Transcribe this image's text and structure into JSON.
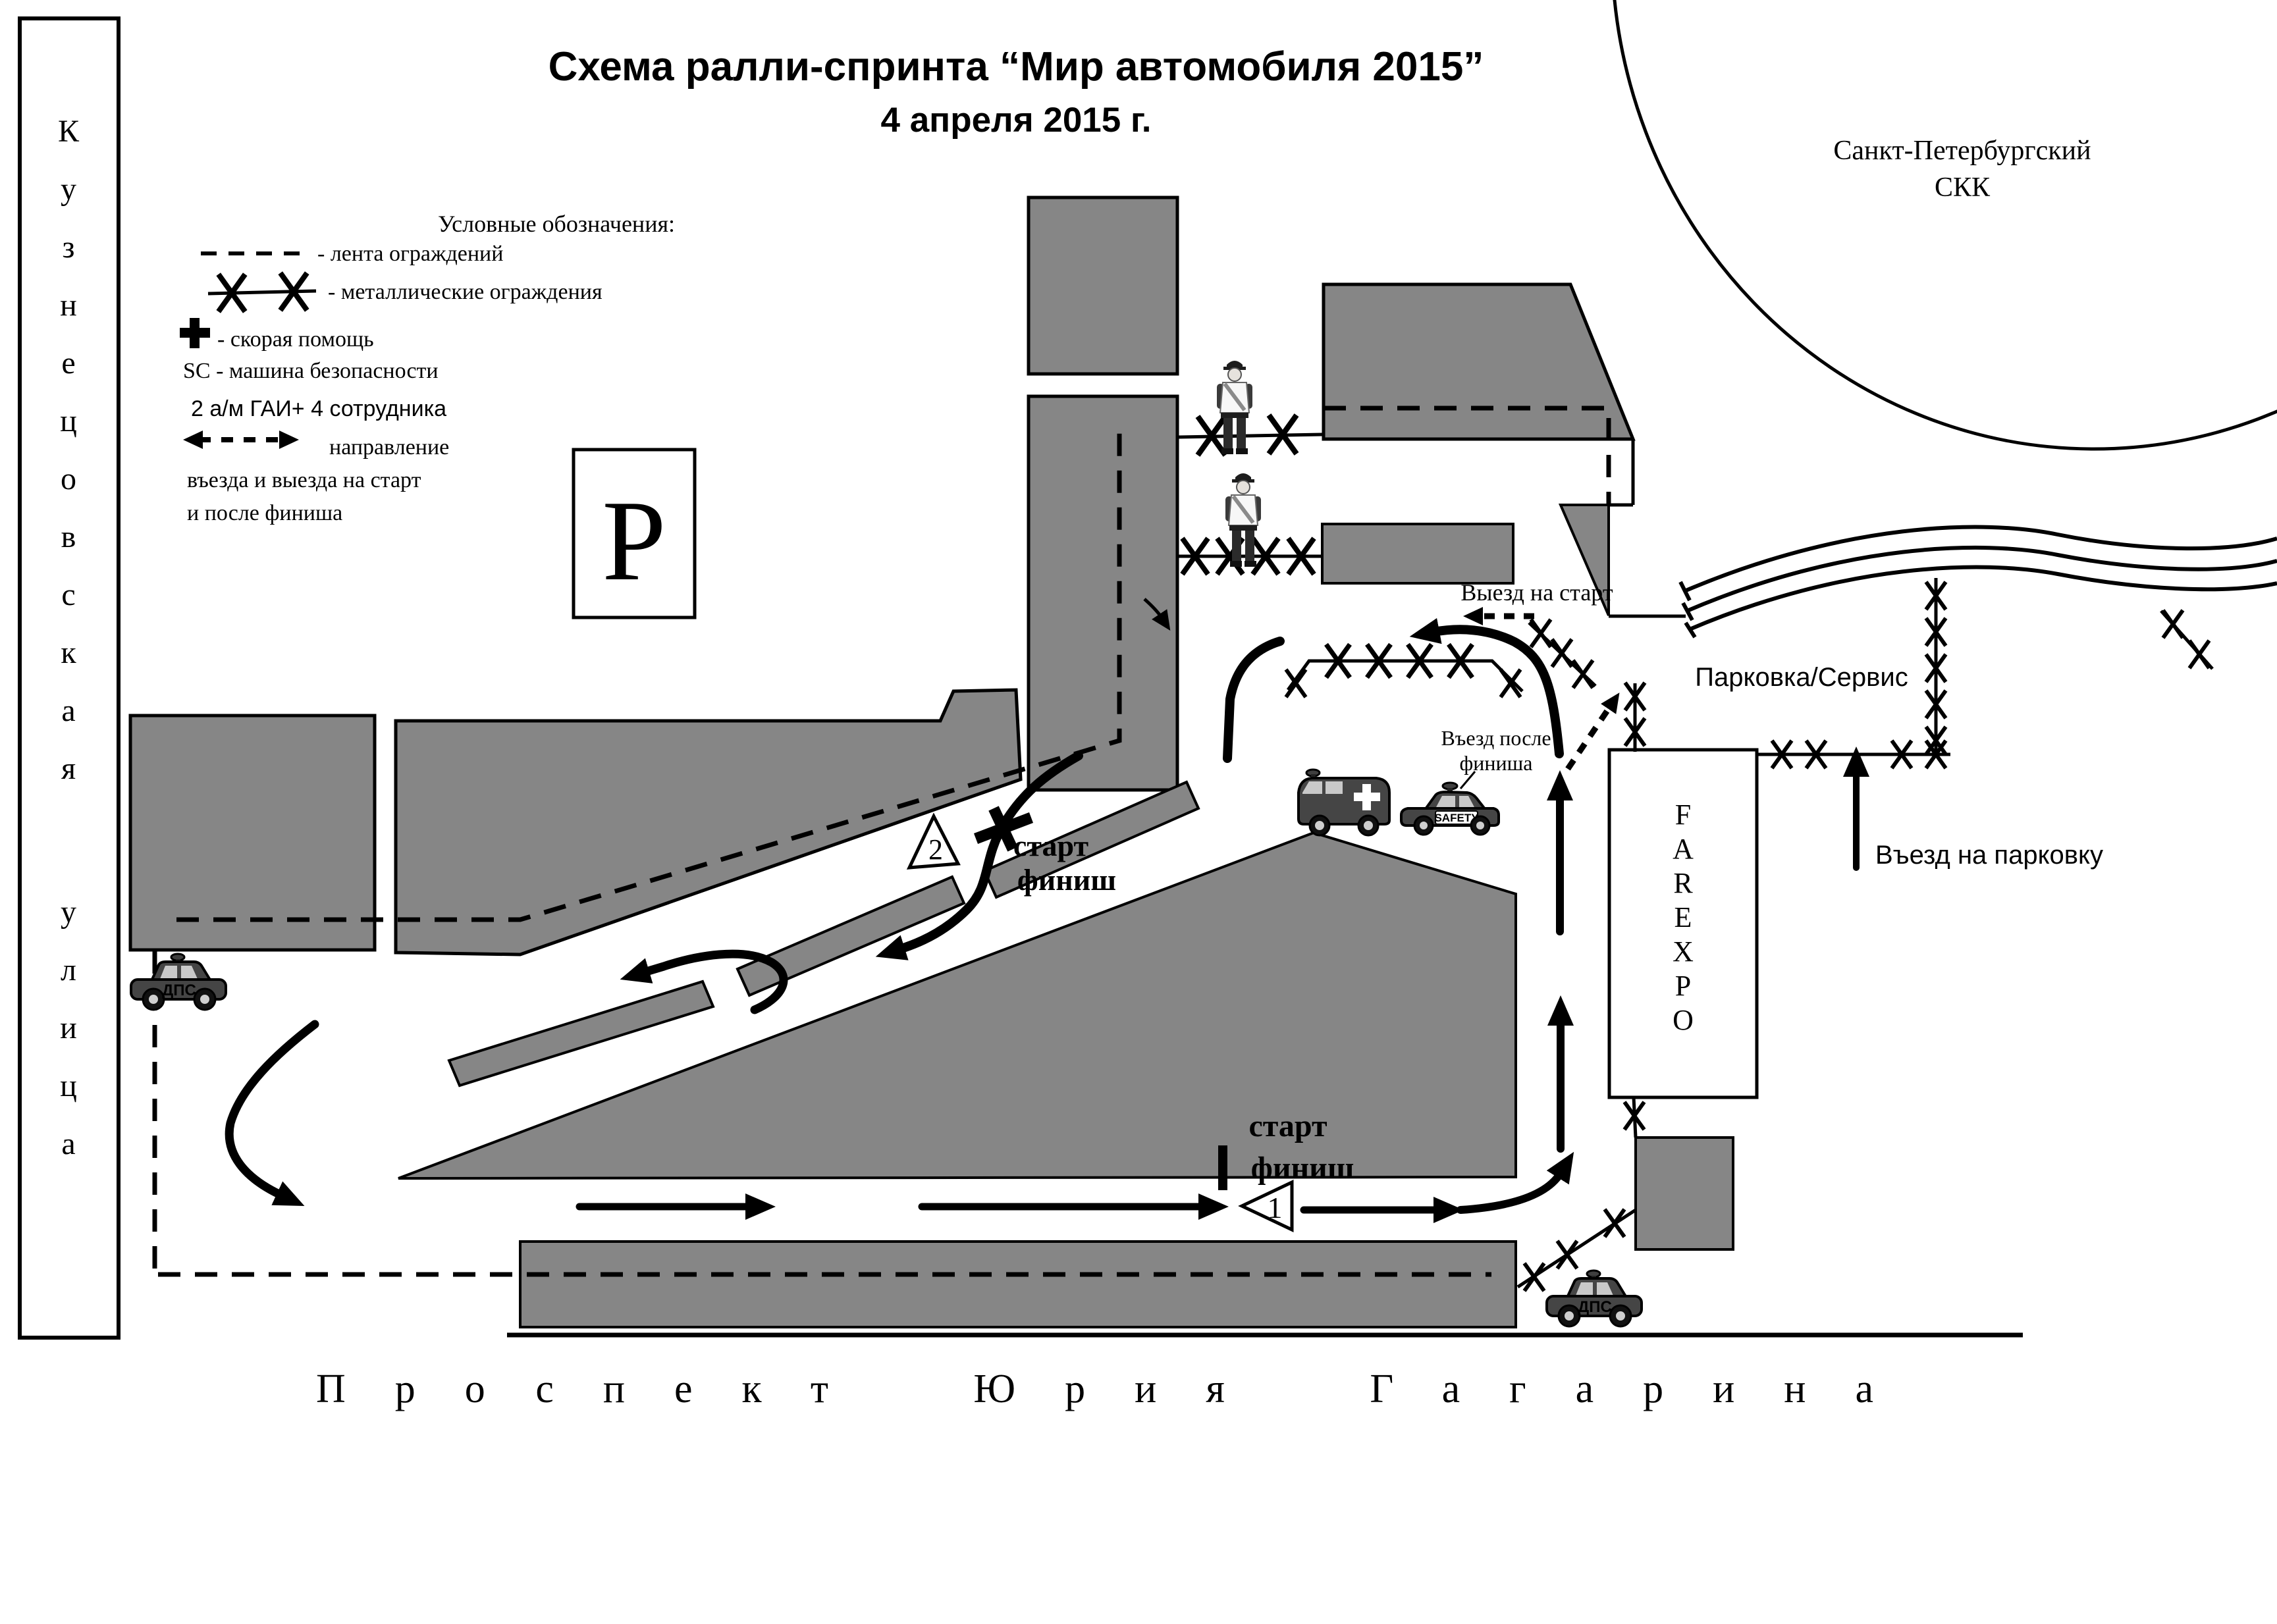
{
  "title": {
    "line1": "Схема ралли-спринта “Мир автомобиля 2015”",
    "line2": "4 апреля 2015 г."
  },
  "legend": {
    "heading": "Условные обозначения:",
    "tape_label": "- лента ограждений",
    "metal_label": "- металлические ограждения",
    "ambulance_label": "- скорая помощь",
    "safety_car_label": "SC - машина безопасности",
    "police_label": "2 а/м ГАИ+ 4 сотрудника",
    "direction_label1": "направление",
    "direction_label2": "въезда и выезда на старт",
    "direction_label3": "и после финиша"
  },
  "parking_sign": "Р",
  "streets": {
    "left_vertical": "Кузнецовская улица",
    "bottom": "Проспект Юрия Гагарина"
  },
  "skk": {
    "line1": "Санкт-Петербургский",
    "line2": "СКК"
  },
  "farexpo": "FAREXPO",
  "labels": {
    "parking_service": "Парковка/Сервис",
    "parking_entry": "Въезд на парковку",
    "start_exit": "Выезд на старт",
    "after_finish_line1": "Въезд после",
    "after_finish_line2": "финиша",
    "start1": "старт",
    "finish1": "финиш",
    "start2": "старт",
    "finish2": "финиш",
    "checkpoint1": "1",
    "checkpoint2": "2"
  },
  "vehicles": {
    "police_label": "ДПС",
    "safety_label": "SAFETY"
  },
  "colors": {
    "building_gray": "#868686",
    "line_black": "#000000"
  }
}
